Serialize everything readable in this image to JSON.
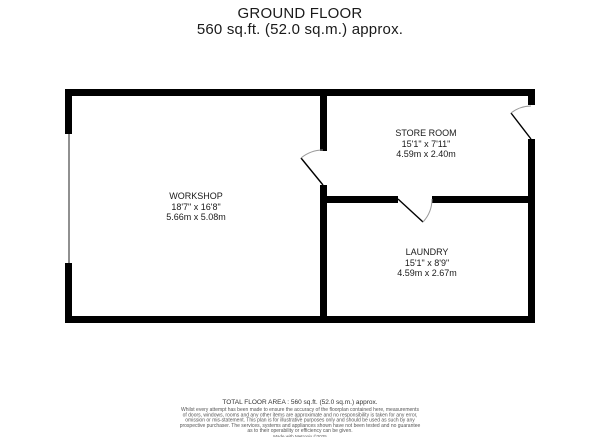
{
  "title": {
    "line1": "GROUND FLOOR",
    "line2": "560 sq.ft. (52.0 sq.m.) approx."
  },
  "rooms": [
    {
      "name": "WORKSHOP",
      "dims_imperial": "18'7\" x 16'8\"",
      "dims_metric": "5.66m x 5.08m"
    },
    {
      "name": "STORE ROOM",
      "dims_imperial": "15'1\" x 7'11\"",
      "dims_metric": "4.59m x 2.40m"
    },
    {
      "name": "LAUNDRY",
      "dims_imperial": "15'1\" x 8'9\"",
      "dims_metric": "4.59m x 2.67m"
    }
  ],
  "footer": {
    "total_area": "TOTAL FLOOR AREA : 560 sq.ft. (52.0 sq.m.) approx.",
    "disclaimer_lines": [
      "Whilst every attempt has been made to ensure the accuracy of the floorplan contained here, measurements",
      "of doors, windows, rooms and any other items are approximate and no responsibility is taken for any error,",
      "omission or mis-statement. This plan is for illustrative purposes only and should be used as such by any",
      "prospective purchaser. The services, systems and appliances shown have not been tested and no guarantee",
      "as to their operability or efficiency can be given."
    ],
    "credit": "Made with Metropix ©2025"
  },
  "colors": {
    "wall": "#000000",
    "window": "#909090",
    "door_arc": "#9a9a9a",
    "text": "#1a1a1a"
  }
}
